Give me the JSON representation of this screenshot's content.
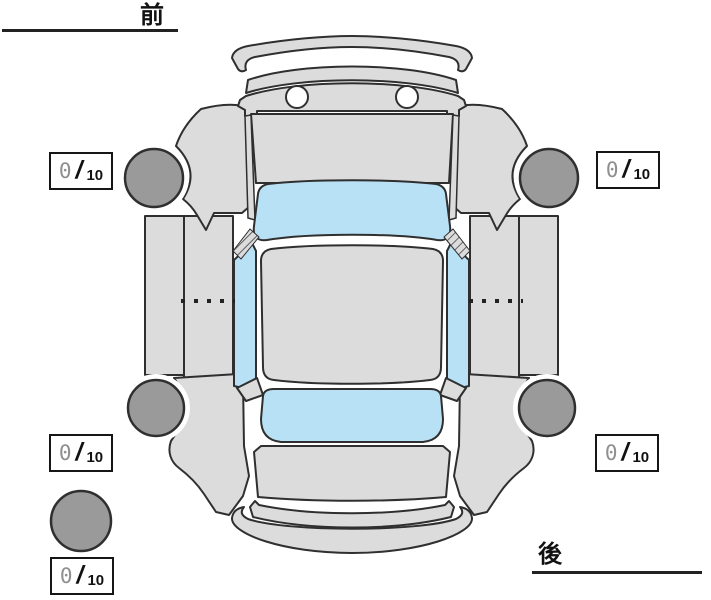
{
  "labels": {
    "front": "前",
    "rear": "後"
  },
  "scores": [
    {
      "position": "front-left",
      "value": "0",
      "divider": "/",
      "max": "10"
    },
    {
      "position": "front-right",
      "value": "0",
      "divider": "/",
      "max": "10"
    },
    {
      "position": "rear-left",
      "value": "0",
      "divider": "/",
      "max": "10"
    },
    {
      "position": "rear-right",
      "value": "0",
      "divider": "/",
      "max": "10"
    },
    {
      "position": "spare",
      "value": "0",
      "divider": "/",
      "max": "10"
    }
  ],
  "diagram": {
    "type": "car-top-view-inspection-sheet",
    "wheels": [
      "front-left",
      "front-right",
      "rear-left",
      "rear-right",
      "spare"
    ],
    "colors": {
      "body": "#dcdcdc",
      "glass": "#b9e1f5",
      "tire": "#9a9a9a",
      "outline": "#2f2f2f",
      "bg": "#ffffff"
    }
  }
}
